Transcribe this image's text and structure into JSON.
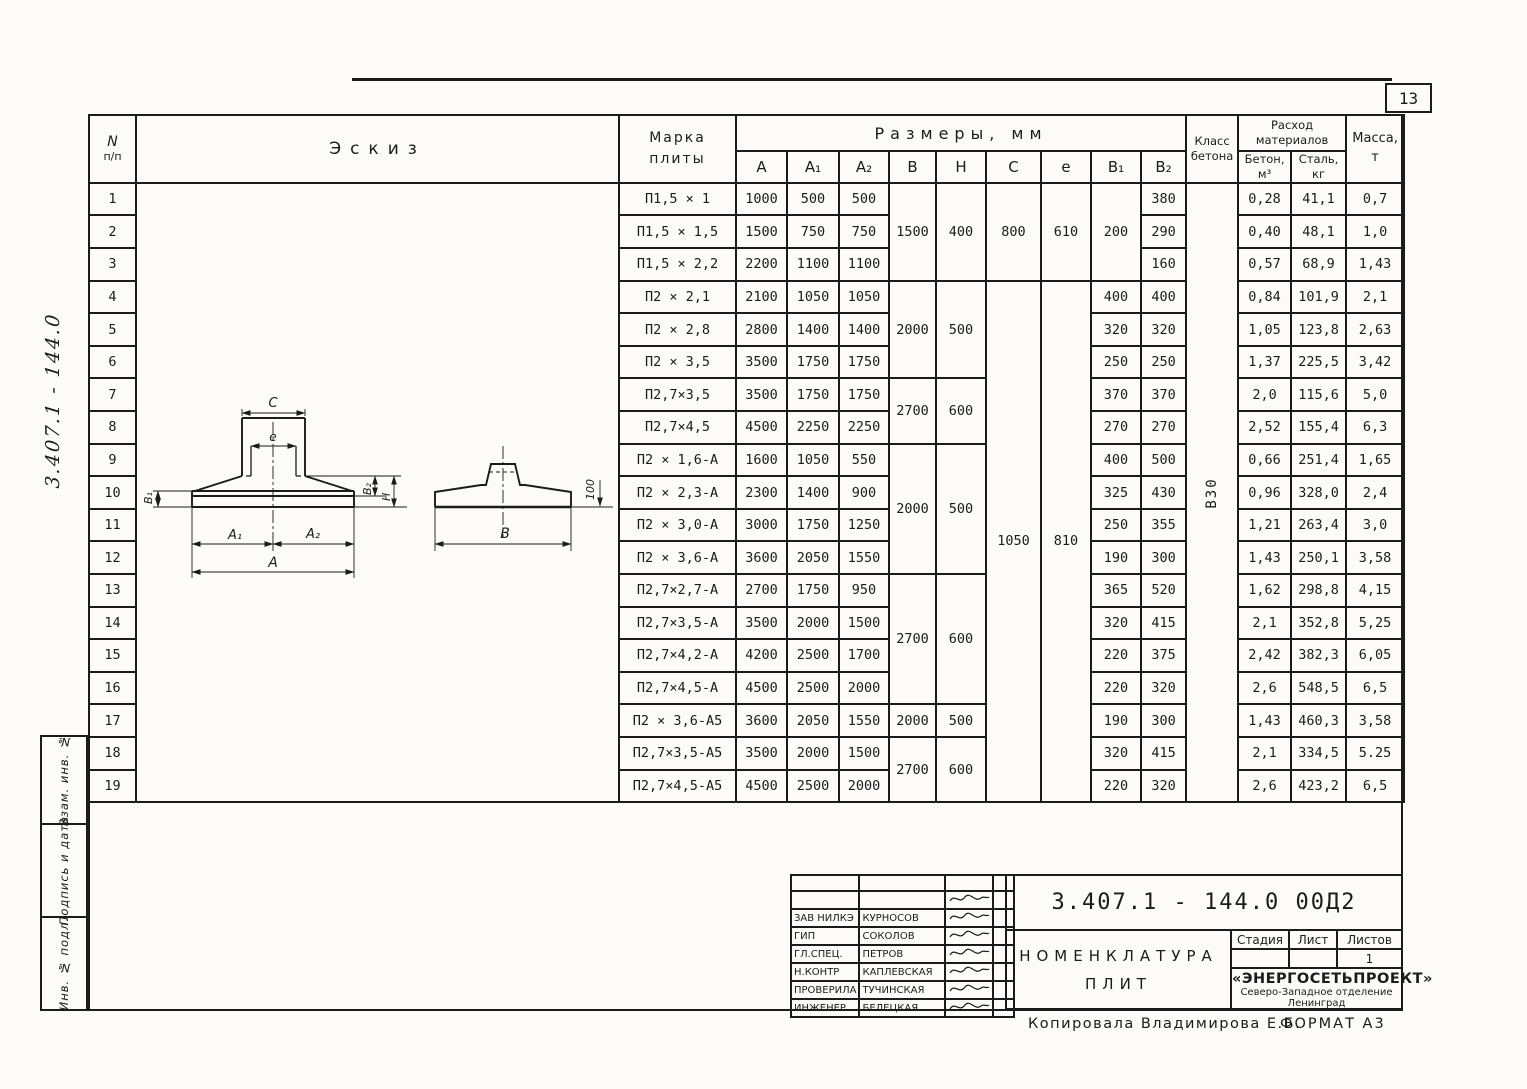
{
  "page": {
    "number": "13",
    "footer_copy": "Копировала  Владимирова Е.Б.",
    "footer_format": "ФОРМАТ А3",
    "margin_note": "3.407.1 - 144.0"
  },
  "sidebar": {
    "fields": [
      "Взам. инв. №",
      "Подпись и дата",
      "Инв. № подл."
    ]
  },
  "table": {
    "header": {
      "num": "N",
      "num2": "п/п",
      "sketch": "Эскиз",
      "mark_l1": "Марка",
      "mark_l2": "плиты",
      "dims": "Размеры,  мм",
      "dim_cols": [
        "А",
        "А₁",
        "А₂",
        "В",
        "Н",
        "С",
        "е",
        "В₁",
        "В₂"
      ],
      "class_l1": "Класс",
      "class_l2": "бетона",
      "consumption_l1": "Расход",
      "consumption_l2": "материалов",
      "concrete_l1": "Бетон,",
      "concrete_l2": "м³",
      "steel_l1": "Сталь,",
      "steel_l2": "кг",
      "mass_l1": "Масса,",
      "mass_l2": "т"
    },
    "concrete_class": "В30",
    "rows": [
      {
        "n": "1",
        "mark": "П1,5 × 1",
        "a": "1000",
        "a1": "500",
        "a2": "500",
        "b2": "380",
        "con": "0,28",
        "st": "41,1",
        "m": "0,7"
      },
      {
        "n": "2",
        "mark": "П1,5 × 1,5",
        "a": "1500",
        "a1": "750",
        "a2": "750",
        "b2": "290",
        "con": "0,40",
        "st": "48,1",
        "m": "1,0"
      },
      {
        "n": "3",
        "mark": "П1,5 × 2,2",
        "a": "2200",
        "a1": "1100",
        "a2": "1100",
        "b2": "160",
        "con": "0,57",
        "st": "68,9",
        "m": "1,43"
      },
      {
        "n": "4",
        "mark": "П2 × 2,1",
        "a": "2100",
        "a1": "1050",
        "a2": "1050",
        "b1": "400",
        "b2": "400",
        "con": "0,84",
        "st": "101,9",
        "m": "2,1"
      },
      {
        "n": "5",
        "mark": "П2 × 2,8",
        "a": "2800",
        "a1": "1400",
        "a2": "1400",
        "b1": "320",
        "b2": "320",
        "con": "1,05",
        "st": "123,8",
        "m": "2,63"
      },
      {
        "n": "6",
        "mark": "П2 × 3,5",
        "a": "3500",
        "a1": "1750",
        "a2": "1750",
        "b1": "250",
        "b2": "250",
        "con": "1,37",
        "st": "225,5",
        "m": "3,42"
      },
      {
        "n": "7",
        "mark": "П2,7×3,5",
        "a": "3500",
        "a1": "1750",
        "a2": "1750",
        "b1": "370",
        "b2": "370",
        "con": "2,0",
        "st": "115,6",
        "m": "5,0"
      },
      {
        "n": "8",
        "mark": "П2,7×4,5",
        "a": "4500",
        "a1": "2250",
        "a2": "2250",
        "b1": "270",
        "b2": "270",
        "con": "2,52",
        "st": "155,4",
        "m": "6,3"
      },
      {
        "n": "9",
        "mark": "П2 × 1,6-А",
        "a": "1600",
        "a1": "1050",
        "a2": "550",
        "b1": "400",
        "b2": "500",
        "con": "0,66",
        "st": "251,4",
        "m": "1,65"
      },
      {
        "n": "10",
        "mark": "П2 × 2,3-А",
        "a": "2300",
        "a1": "1400",
        "a2": "900",
        "b1": "325",
        "b2": "430",
        "con": "0,96",
        "st": "328,0",
        "m": "2,4"
      },
      {
        "n": "11",
        "mark": "П2 × 3,0-А",
        "a": "3000",
        "a1": "1750",
        "a2": "1250",
        "b1": "250",
        "b2": "355",
        "con": "1,21",
        "st": "263,4",
        "m": "3,0"
      },
      {
        "n": "12",
        "mark": "П2 × 3,6-А",
        "a": "3600",
        "a1": "2050",
        "a2": "1550",
        "b1": "190",
        "b2": "300",
        "con": "1,43",
        "st": "250,1",
        "m": "3,58"
      },
      {
        "n": "13",
        "mark": "П2,7×2,7-А",
        "a": "2700",
        "a1": "1750",
        "a2": "950",
        "b1": "365",
        "b2": "520",
        "con": "1,62",
        "st": "298,8",
        "m": "4,15"
      },
      {
        "n": "14",
        "mark": "П2,7×3,5-А",
        "a": "3500",
        "a1": "2000",
        "a2": "1500",
        "b1": "320",
        "b2": "415",
        "con": "2,1",
        "st": "352,8",
        "m": "5,25"
      },
      {
        "n": "15",
        "mark": "П2,7×4,2-А",
        "a": "4200",
        "a1": "2500",
        "a2": "1700",
        "b1": "220",
        "b2": "375",
        "con": "2,42",
        "st": "382,3",
        "m": "6,05"
      },
      {
        "n": "16",
        "mark": "П2,7×4,5-А",
        "a": "4500",
        "a1": "2500",
        "a2": "2000",
        "b1": "220",
        "b2": "320",
        "con": "2,6",
        "st": "548,5",
        "m": "6,5"
      },
      {
        "n": "17",
        "mark": "П2 × 3,6-А5",
        "a": "3600",
        "a1": "2050",
        "a2": "1550",
        "b1": "190",
        "b2": "300",
        "con": "1,43",
        "st": "460,3",
        "m": "3,58"
      },
      {
        "n": "18",
        "mark": "П2,7×3,5-А5",
        "a": "3500",
        "a1": "2000",
        "a2": "1500",
        "b1": "320",
        "b2": "415",
        "con": "2,1",
        "st": "334,5",
        "m": "5.25"
      },
      {
        "n": "19",
        "mark": "П2,7×4,5-А5",
        "a": "4500",
        "a1": "2500",
        "a2": "2000",
        "b1": "220",
        "b2": "320",
        "con": "2,6",
        "st": "423,2",
        "m": "6,5"
      }
    ],
    "bh_groups": [
      {
        "from": 1,
        "to": 3,
        "b": "1500",
        "h": "400"
      },
      {
        "from": 4,
        "to": 6,
        "b": "2000",
        "h": "500"
      },
      {
        "from": 7,
        "to": 8,
        "b": "2700",
        "h": "600"
      },
      {
        "from": 9,
        "to": 12,
        "b": "2000",
        "h": "500"
      },
      {
        "from": 13,
        "to": 16,
        "b": "2700",
        "h": "600"
      },
      {
        "from": 17,
        "to": 17,
        "b": "2000",
        "h": "500"
      },
      {
        "from": 18,
        "to": 19,
        "b": "2700",
        "h": "600"
      }
    ],
    "ce_groups": [
      {
        "from": 1,
        "to": 3,
        "c": "800",
        "e": "610"
      },
      {
        "from": 4,
        "to": 19,
        "c": "1050",
        "e": "810"
      }
    ],
    "b1_groups": [
      {
        "from": 1,
        "to": 3,
        "v": "200"
      }
    ]
  },
  "sketch": {
    "labels": {
      "c": "С",
      "e": "е",
      "b1": "В₁",
      "b2": "В₂",
      "h": "Н",
      "a1": "А₁",
      "a2": "А₂",
      "a": "А",
      "b": "В",
      "d100": "100"
    }
  },
  "title_block": {
    "doc_number": "3.407.1 - 144.0   00Д2",
    "title_l1": "НОМЕНКЛАТУРА",
    "title_l2": "ПЛИТ",
    "stage_cols": [
      "Стадия",
      "Лист",
      "Листов"
    ],
    "stage_values": [
      "",
      "",
      "1"
    ],
    "org_name": "«ЭНЕРГОСЕТЬПРОЕКТ»",
    "org_l2": "Северо-Западное отделение",
    "org_l3": "Ленинград",
    "signatures": [
      {
        "role": "Зав НИЛКЭ",
        "name": "Курносов"
      },
      {
        "role": "ГИП",
        "name": "Соколов"
      },
      {
        "role": "Гл.спец.",
        "name": "Петров"
      },
      {
        "role": "Н.контр",
        "name": "Каплевская"
      },
      {
        "role": "Проверила",
        "name": "Тучинская"
      },
      {
        "role": "Инженер",
        "name": "Белецкая"
      }
    ]
  }
}
